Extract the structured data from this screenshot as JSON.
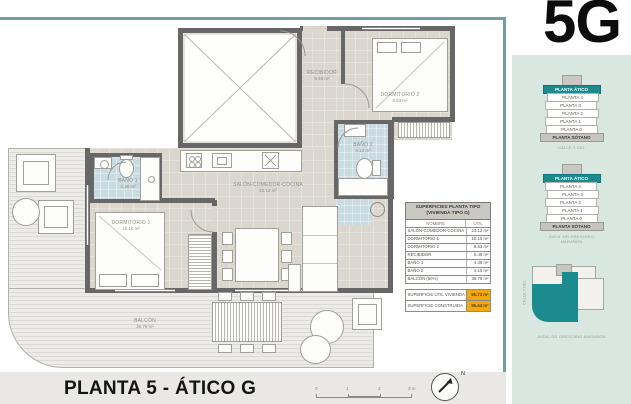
{
  "page": {
    "unit_code": "5G",
    "title": "PLANTA 5 - ÁTICO G"
  },
  "plan": {
    "rooms": [
      {
        "name": "RECIBIDOR",
        "area": "5.48 m²"
      },
      {
        "name": "DORMITORIO 2",
        "area": "8.53 m²"
      },
      {
        "name": "BAÑO 2",
        "area": "4.10 m²"
      },
      {
        "name": "BAÑO 1",
        "area": "4.38 m²"
      },
      {
        "name": "DORMITORIO 1",
        "area": "10.10 m²"
      },
      {
        "name": "SALÓN-COMEDOR-COCINA",
        "area": "23.12 m²"
      },
      {
        "name": "BALCÓN",
        "area": "38.78 m²"
      }
    ],
    "scale_ticks": [
      "0",
      "1",
      "2",
      "3 m"
    ],
    "north_label": "N"
  },
  "surfaces_table": {
    "title_line1": "SUPERFICIES PLANTA TIPO",
    "title_line2": "(VIVIENDA TIPO G)",
    "col_name": "NOMBRE",
    "col_util": "ÚTIL",
    "rows": [
      {
        "name": "SALÓN-COMEDOR-COCINA",
        "util": "23.12 m²"
      },
      {
        "name": "DORMITORIO 1",
        "util": "10.10 m²"
      },
      {
        "name": "DORMITORIO 2",
        "util": "8.53 m²"
      },
      {
        "name": "RECIBIDOR",
        "util": "5.48 m²"
      },
      {
        "name": "BAÑO 1",
        "util": "4.38 m²"
      },
      {
        "name": "BAÑO 2",
        "util": "4.10 m²"
      },
      {
        "name": "BALCÓN (50%)",
        "util": "38.78 m²"
      }
    ],
    "summary": [
      {
        "name": "SUPERFICIE ÚTIL VIVIENDA",
        "value": "55.73 m²"
      },
      {
        "name": "SUPERFICIE CONSTRUIDA",
        "value": "95.44 m²"
      }
    ]
  },
  "sidebar": {
    "stack1": {
      "levels": [
        "PLANTA ÁTICO",
        "PLANTA 4",
        "PLANTA 3",
        "PLANTA 2",
        "PLANTA 1",
        "PLANTA 0",
        "PLANTA SÓTANO"
      ],
      "caption": "CALLE 3 DEL"
    },
    "stack2": {
      "levels": [
        "PLANTA ÁTICO",
        "PLANTA 4",
        "PLANTA 3",
        "PLANTA 2",
        "PLANTA 1",
        "PLANTA 0",
        "PLANTA SÓTANO"
      ],
      "caption": "AVDA. DR GREGORIO MARAÑÓN"
    },
    "siteplan": {
      "caption": "AVDA. DR GREGORIO MARAÑÓN",
      "side_label": "CALLE 3 DEL"
    }
  },
  "colors": {
    "accent_teal": "#1b8b90",
    "highlight_orange": "#f3a90e",
    "bath_blue": "#c9dce2",
    "wall_gray": "#676767"
  }
}
